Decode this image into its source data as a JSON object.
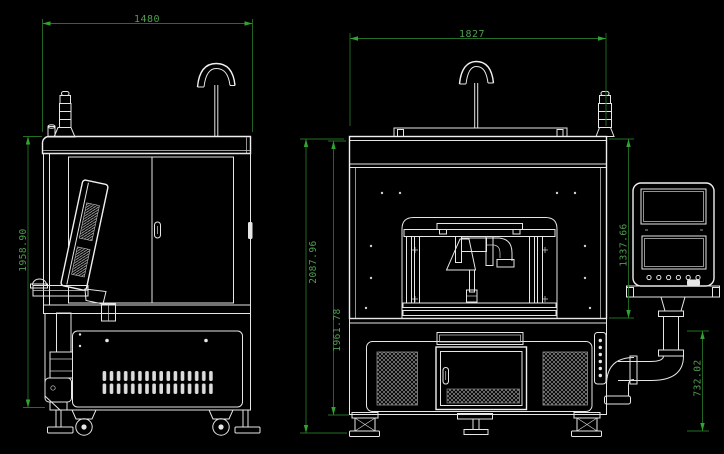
{
  "drawing": {
    "type": "cad-engineering-drawing",
    "background_color": "#000000",
    "line_color": "#e6e6e6",
    "dimension_line_color": "#256f25",
    "dimension_text_color": "#4f9e4f",
    "views": {
      "side": {
        "name": "machine side view",
        "dims": {
          "width": "1480",
          "height": "1958.90"
        }
      },
      "front": {
        "name": "machine front view",
        "dims": {
          "width": "1827",
          "overall_height": "2087.96",
          "body_height": "1961.78",
          "enclosure_height": "1337.66",
          "lower_height": "732.02"
        }
      }
    }
  }
}
